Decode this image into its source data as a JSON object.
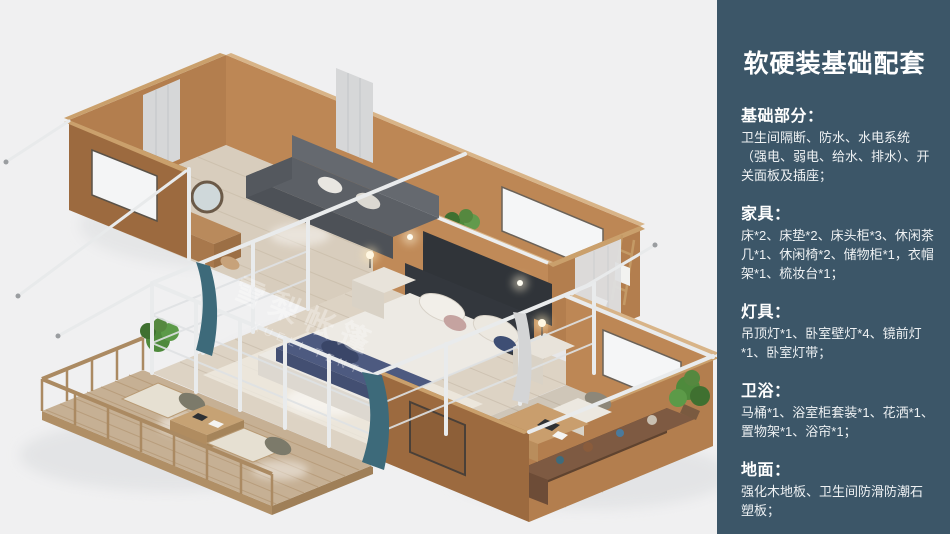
{
  "sidebar": {
    "title": "软硬装基础配套",
    "sections": [
      {
        "heading": "基础部分：",
        "body": "卫生间隔断、防水、水电系统（强电、弱电、给水、排水）、开关面板及插座；"
      },
      {
        "heading": "家具：",
        "body": "床*2、床垫*2、床头柜*3、休闲茶几*1、休闲椅*2、储物柜*1，衣帽架*1、梳妆台*1；"
      },
      {
        "heading": "灯具：",
        "body": "吊顶灯*1、卧室壁灯*4、镜前灯*1、卧室灯带；"
      },
      {
        "heading": "卫浴：",
        "body": "马桶*1、浴室柜套装*1、花洒*1、置物架*1、浴帘*1；"
      },
      {
        "heading": "地面：",
        "body": "强化木地板、卫生间防滑防潮石塑板；"
      }
    ]
  },
  "illustration": {
    "watermark_cn": "雪梨帐篷",
    "watermark_en": "XUELI TENT"
  },
  "colors": {
    "sidebar_bg": "#3c5668",
    "canvas_bg": "#f0f0f1",
    "wall_tan": "#bc8656",
    "curtain_teal": "#3d6a7a"
  }
}
